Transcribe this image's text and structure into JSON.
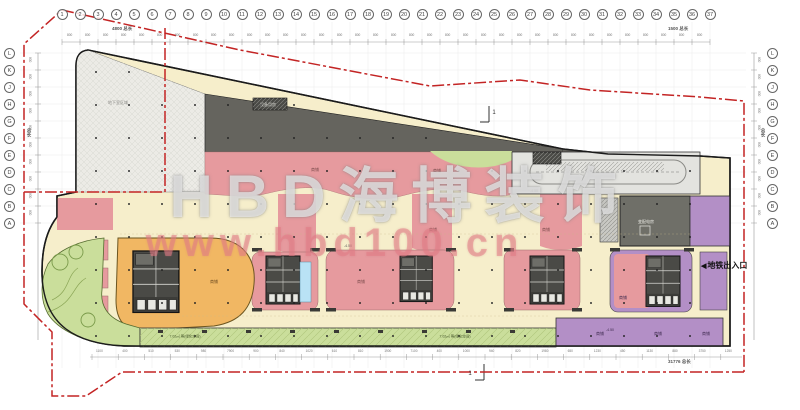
{
  "watermark": {
    "brand": "HBD海博装饰",
    "url": "www.hbd100.cn"
  },
  "grid": {
    "columns": [
      "1",
      "2",
      "3",
      "4",
      "5",
      "6",
      "7",
      "8",
      "9",
      "10",
      "11",
      "12",
      "13",
      "14",
      "15",
      "16",
      "17",
      "18",
      "19",
      "20",
      "21",
      "22",
      "23",
      "24",
      "25",
      "26",
      "27",
      "28",
      "29",
      "30",
      "31",
      "32",
      "33",
      "34",
      "35",
      "36",
      "37"
    ],
    "rows": [
      "L",
      "K",
      "J",
      "H",
      "G",
      "F",
      "E",
      "D",
      "C",
      "B",
      "A"
    ]
  },
  "dimensions": {
    "top": {
      "tick": "800",
      "total_left": "4800 总长",
      "total_right": "1500 总长"
    },
    "bottom": {
      "ticks": [
        "1100",
        "400",
        "510",
        "530",
        "980",
        "7900",
        "900",
        "840",
        "1020",
        "610",
        "810",
        "1900",
        "7100",
        "400",
        "1000",
        "940",
        "820",
        "1980",
        "650",
        "1230",
        "450",
        "1130",
        "880",
        "3750",
        "1250"
      ],
      "total": "31776 总长"
    },
    "left": {
      "tick": "800",
      "total": "总长"
    },
    "right": {
      "tick": "800",
      "total": "总长"
    }
  },
  "annotations": {
    "subway_arrow": "◀",
    "subway_text": "地铁出入口"
  },
  "plan_labels": [
    {
      "text": "地下室区域",
      "x": 118,
      "y": 103,
      "size": 4,
      "color": "#8a8a86"
    },
    {
      "text": "设备用房",
      "x": 268,
      "y": 105,
      "size": 4,
      "color": "#d9d9d3"
    },
    {
      "text": "商铺",
      "x": 315,
      "y": 170,
      "size": 4,
      "color": "#7a4a4a"
    },
    {
      "text": "商铺",
      "x": 437,
      "y": 171,
      "size": 4,
      "color": "#7a4a4a"
    },
    {
      "text": "商铺",
      "x": 433,
      "y": 230,
      "size": 4,
      "color": "#7a4a4a"
    },
    {
      "text": "商铺",
      "x": 546,
      "y": 230,
      "size": 4,
      "color": "#7a4a4a"
    },
    {
      "text": "商铺",
      "x": 361,
      "y": 282,
      "size": 4,
      "color": "#7a4a4a"
    },
    {
      "text": "商铺",
      "x": 214,
      "y": 282,
      "size": 4,
      "color": "#6b4a20"
    },
    {
      "text": "商铺",
      "x": 623,
      "y": 298,
      "size": 4,
      "color": "#3f2b4f"
    },
    {
      "text": "商铺",
      "x": 600,
      "y": 334,
      "size": 4,
      "color": "#3f2b4f"
    },
    {
      "text": "商铺",
      "x": 658,
      "y": 334,
      "size": 4,
      "color": "#3f2b4f"
    },
    {
      "text": "商铺",
      "x": 706,
      "y": 334,
      "size": 4,
      "color": "#3f2b4f"
    },
    {
      "text": "变配电房",
      "x": 646,
      "y": 222,
      "size": 4,
      "color": "#eeeee8"
    },
    {
      "text": "7.02㎡ 等(绿化空间)",
      "x": 185,
      "y": 337,
      "size": 3.5,
      "color": "#44552a"
    },
    {
      "text": "7.02㎡ 等(绿化空间)",
      "x": 455,
      "y": 337,
      "size": 3.5,
      "color": "#44552a"
    },
    {
      "text": "-4.50",
      "x": 348,
      "y": 246,
      "size": 3.5,
      "color": "#555555"
    },
    {
      "text": "-4.50",
      "x": 534,
      "y": 191,
      "size": 3.5,
      "color": "#555555"
    },
    {
      "text": "-4.50",
      "x": 610,
      "y": 330,
      "size": 3.5,
      "color": "#3f2b4f"
    },
    {
      "text": "1",
      "x": 494,
      "y": 113,
      "size": 6,
      "color": "#333333"
    },
    {
      "text": "1",
      "x": 470,
      "y": 374,
      "size": 6,
      "color": "#333333"
    }
  ],
  "colors": {
    "boundary": "#c32424",
    "shop_pink": "#e69a9e",
    "corridor_cream": "#f6eecb",
    "anchor_orange": "#f1b763",
    "landscape_green": "#cade9b",
    "service_purple": "#b38fc6",
    "core_gray": "#4a4a46",
    "equipment_gray": "#65645e"
  }
}
